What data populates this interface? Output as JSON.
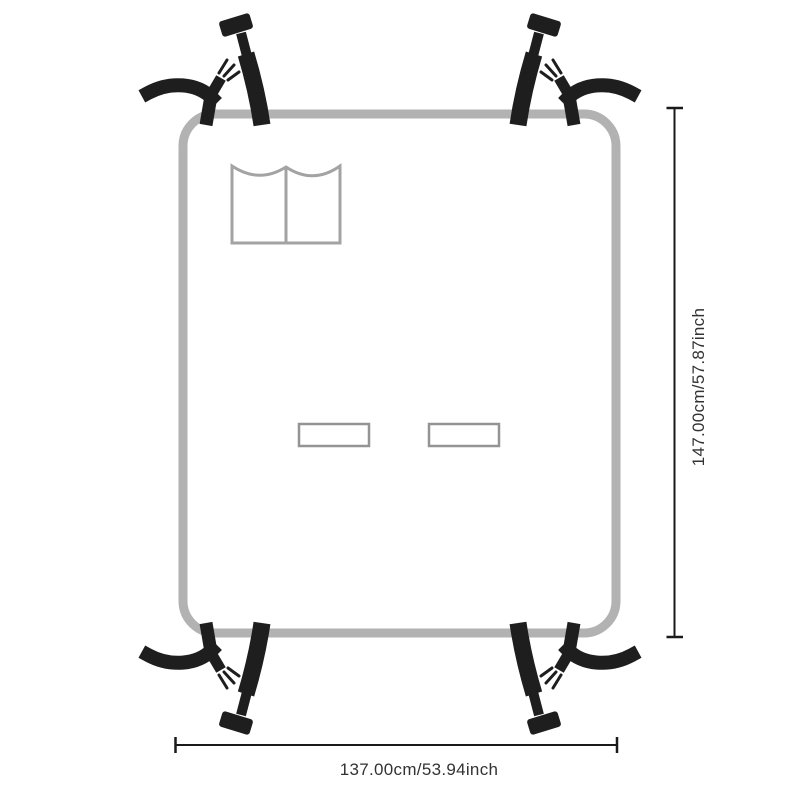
{
  "diagram": {
    "kind": "product-dimension-diagram"
  },
  "dimensions": {
    "height_label": "147.00cm/57.87inch",
    "width_label": "137.00cm/53.94inch"
  },
  "colors": {
    "strap": "#1e1e1e",
    "cover_outline": "#b2b2b2",
    "pocket_outline": "#a3a3a3",
    "slot_outline": "#949494",
    "dimension_line": "#1a1a1a",
    "dimension_text": "#333333",
    "background": "#ffffff"
  }
}
